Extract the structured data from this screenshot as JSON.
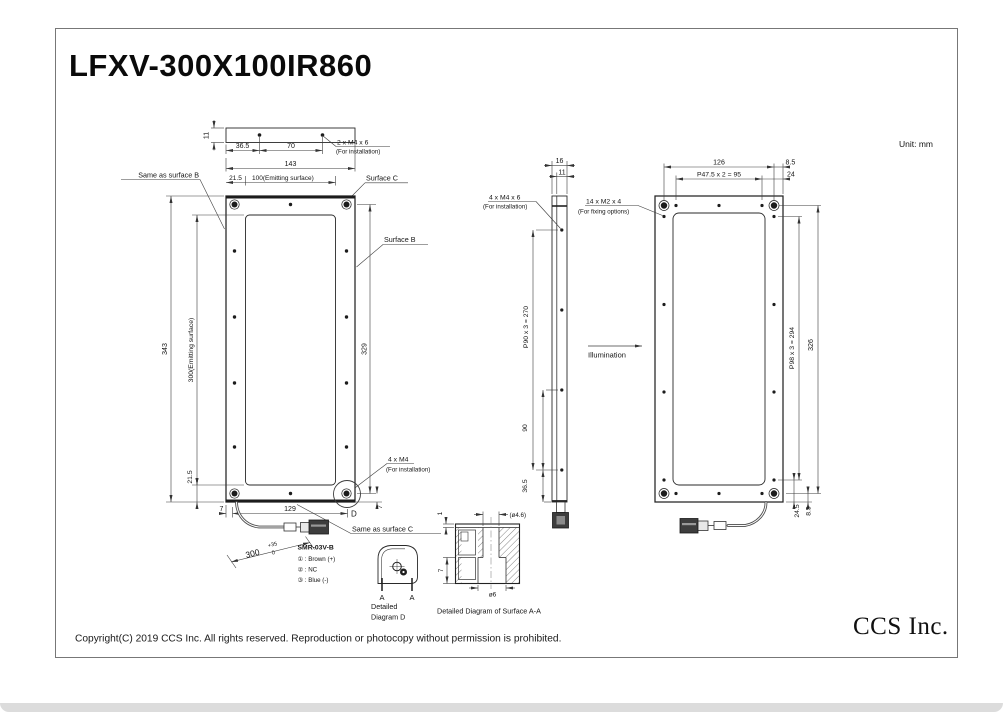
{
  "title": "LFXV-300X100IR860",
  "unit_label": "Unit: mm",
  "colors": {
    "line": "#2b2b2b",
    "background": "#ffffff"
  },
  "top_view": {
    "dim_thickness": "11",
    "dim_hole_offset": "36.5",
    "dim_hole_pitch": "70",
    "hole_note": "2 x M4 x 6",
    "hole_note_sub": "(For installation)",
    "dim_overall_width": "143",
    "dim_edge_margin": "21.5",
    "dim_emitting_width": "100(Emitting surface)",
    "label_same_as_b": "Same as surface B",
    "label_surface_c": "Surface C"
  },
  "front_view": {
    "dim_overall_height": "343",
    "dim_emitting_height": "300(Emitting surface)",
    "dim_hole_span": "329",
    "dim_bottom_margin": "21.5",
    "dim_cable_offset": "7",
    "dim_bottom_pitch": "129",
    "dim_corner_offset": "7",
    "label_surface_b": "Surface B",
    "hole_note": "4 x M4",
    "hole_note_sub": "(For installation)",
    "detail_marker": "D",
    "label_same_as_c": "Same as surface C",
    "cable_length": "300",
    "cable_tol_upper": "+35",
    "cable_tol_lower": "0",
    "connector_name": "SMR-03V-B",
    "pin_1": "① : Brown (+)",
    "pin_2": "② : NC",
    "pin_3": "③ : Blue (-)"
  },
  "side_view": {
    "dim_depth": "16",
    "dim_body_depth": "11",
    "hole_note": "4 x M4 x 6",
    "hole_note_sub": "(For installation)",
    "dim_hole_pitch": "P90 x 3 = 270",
    "dim_hole_gap": "90",
    "dim_bottom_offset": "36.5",
    "illumination_label": "Illumination"
  },
  "back_view": {
    "dim_width": "126",
    "dim_top_pitch": "P47.5 x 2 = 95",
    "dim_corner_margin": "8.5",
    "dim_hole_margin": "24",
    "hole_note": "14 x M2 x 4",
    "hole_note_sub": "(For fixing options)",
    "dim_side_pitch": "P98 x 3 = 294",
    "dim_hole_span": "326",
    "dim_bottom_hole_offset": "24.5",
    "dim_bottom_corner_offset": "8.5"
  },
  "detail_d": {
    "section_label_left": "A",
    "section_label_right": "A",
    "caption_line1": "Detailed",
    "caption_line2": "Diagram D"
  },
  "detail_aa": {
    "dim_top_plate": "1",
    "dim_hole": "(ø4.6)",
    "dim_depth": "7",
    "dim_counterbore": "ø6",
    "caption": "Detailed Diagram of Surface A-A"
  },
  "footer": {
    "copyright": "Copyright(C) 2019 CCS Inc. All rights reserved. Reproduction or photocopy without permission is prohibited.",
    "company_logo": "CCS Inc."
  }
}
